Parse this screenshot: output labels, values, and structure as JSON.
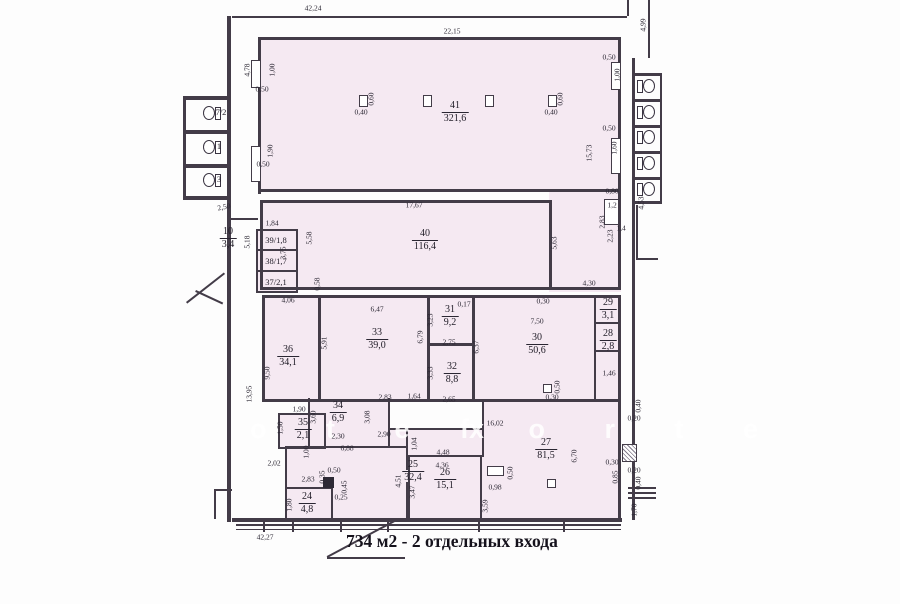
{
  "note": {
    "text": "734 м2 - 2 отдельных входа"
  },
  "plan": {
    "colors": {
      "fill": "#f5e9f2",
      "wall": "#433c48",
      "text": "#2a2632"
    },
    "watermark": [
      {
        "t": "o t e x",
        "x": 250,
        "y": 414
      },
      {
        "t": "f o r t e",
        "x": 460,
        "y": 414
      }
    ],
    "fills": [
      {
        "x": 258,
        "y": 37,
        "w": 363,
        "h": 155
      },
      {
        "x": 260,
        "y": 200,
        "w": 292,
        "h": 90
      },
      {
        "x": 549,
        "y": 190,
        "w": 72,
        "h": 102
      },
      {
        "x": 256,
        "y": 229,
        "w": 42,
        "h": 64
      },
      {
        "x": 262,
        "y": 295,
        "w": 359,
        "h": 107
      },
      {
        "x": 308,
        "y": 398,
        "w": 82,
        "h": 50
      },
      {
        "x": 278,
        "y": 413,
        "w": 48,
        "h": 36
      },
      {
        "x": 285,
        "y": 446,
        "w": 336,
        "h": 72
      },
      {
        "x": 482,
        "y": 402,
        "w": 139,
        "h": 116
      },
      {
        "x": 388,
        "y": 428,
        "w": 96,
        "h": 20
      }
    ],
    "walls": [
      {
        "x": 232,
        "y": 16,
        "w": 395,
        "h": 2
      },
      {
        "x": 227,
        "y": 16,
        "w": 4,
        "h": 506
      },
      {
        "x": 632,
        "y": 58,
        "w": 3,
        "h": 462
      },
      {
        "x": 627,
        "y": 0,
        "w": 2,
        "h": 16
      },
      {
        "x": 648,
        "y": 0,
        "w": 2,
        "h": 58
      },
      {
        "x": 232,
        "y": 518,
        "w": 390,
        "h": 4
      },
      {
        "x": 236,
        "y": 524,
        "w": 385,
        "h": 2
      },
      {
        "x": 236,
        "y": 529,
        "w": 385,
        "h": 1
      },
      {
        "x": 263,
        "y": 521,
        "w": 2,
        "h": 11
      },
      {
        "x": 292,
        "y": 521,
        "w": 2,
        "h": 11
      },
      {
        "x": 340,
        "y": 521,
        "w": 2,
        "h": 11
      },
      {
        "x": 387,
        "y": 521,
        "w": 2,
        "h": 11
      },
      {
        "x": 478,
        "y": 521,
        "w": 2,
        "h": 11
      },
      {
        "x": 563,
        "y": 521,
        "w": 2,
        "h": 11
      },
      {
        "x": 258,
        "y": 37,
        "w": 363,
        "h": 3
      },
      {
        "x": 258,
        "y": 37,
        "w": 3,
        "h": 157
      },
      {
        "x": 618,
        "y": 37,
        "w": 3,
        "h": 157
      },
      {
        "x": 258,
        "y": 189,
        "w": 363,
        "h": 3
      },
      {
        "x": 260,
        "y": 200,
        "w": 292,
        "h": 3
      },
      {
        "x": 260,
        "y": 200,
        "w": 3,
        "h": 90
      },
      {
        "x": 549,
        "y": 200,
        "w": 3,
        "h": 87
      },
      {
        "x": 260,
        "y": 287,
        "w": 361,
        "h": 3
      },
      {
        "x": 618,
        "y": 190,
        "w": 3,
        "h": 100
      },
      {
        "x": 256,
        "y": 229,
        "w": 42,
        "h": 2
      },
      {
        "x": 256,
        "y": 229,
        "w": 2,
        "h": 64
      },
      {
        "x": 296,
        "y": 229,
        "w": 2,
        "h": 64
      },
      {
        "x": 256,
        "y": 249,
        "w": 42,
        "h": 2
      },
      {
        "x": 256,
        "y": 270,
        "w": 42,
        "h": 2
      },
      {
        "x": 256,
        "y": 291,
        "w": 42,
        "h": 2
      },
      {
        "x": 230,
        "y": 218,
        "w": 28,
        "h": 2
      },
      {
        "x": 262,
        "y": 295,
        "w": 359,
        "h": 3
      },
      {
        "x": 262,
        "y": 295,
        "w": 3,
        "h": 107
      },
      {
        "x": 618,
        "y": 295,
        "w": 3,
        "h": 107
      },
      {
        "x": 262,
        "y": 399,
        "w": 359,
        "h": 3
      },
      {
        "x": 318,
        "y": 295,
        "w": 3,
        "h": 104
      },
      {
        "x": 427,
        "y": 295,
        "w": 3,
        "h": 104
      },
      {
        "x": 472,
        "y": 295,
        "w": 3,
        "h": 104
      },
      {
        "x": 427,
        "y": 343,
        "w": 45,
        "h": 3
      },
      {
        "x": 594,
        "y": 295,
        "w": 2,
        "h": 104
      },
      {
        "x": 594,
        "y": 322,
        "w": 26,
        "h": 2
      },
      {
        "x": 594,
        "y": 350,
        "w": 26,
        "h": 2
      },
      {
        "x": 308,
        "y": 398,
        "w": 2,
        "h": 50
      },
      {
        "x": 388,
        "y": 398,
        "w": 2,
        "h": 50
      },
      {
        "x": 308,
        "y": 446,
        "w": 82,
        "h": 2
      },
      {
        "x": 278,
        "y": 413,
        "w": 48,
        "h": 2
      },
      {
        "x": 278,
        "y": 413,
        "w": 2,
        "h": 36
      },
      {
        "x": 324,
        "y": 413,
        "w": 2,
        "h": 36
      },
      {
        "x": 278,
        "y": 447,
        "w": 48,
        "h": 2
      },
      {
        "x": 388,
        "y": 428,
        "w": 96,
        "h": 2
      },
      {
        "x": 285,
        "y": 446,
        "w": 2,
        "h": 72
      },
      {
        "x": 285,
        "y": 446,
        "w": 25,
        "h": 2
      },
      {
        "x": 406,
        "y": 428,
        "w": 2,
        "h": 42
      },
      {
        "x": 406,
        "y": 482,
        "w": 2,
        "h": 36
      },
      {
        "x": 390,
        "y": 446,
        "w": 18,
        "h": 2
      },
      {
        "x": 482,
        "y": 402,
        "w": 2,
        "h": 55
      },
      {
        "x": 408,
        "y": 455,
        "w": 74,
        "h": 2
      },
      {
        "x": 408,
        "y": 455,
        "w": 2,
        "h": 63
      },
      {
        "x": 480,
        "y": 455,
        "w": 2,
        "h": 63
      },
      {
        "x": 285,
        "y": 487,
        "w": 48,
        "h": 2
      },
      {
        "x": 331,
        "y": 487,
        "w": 2,
        "h": 31
      },
      {
        "x": 618,
        "y": 402,
        "w": 3,
        "h": 118
      },
      {
        "x": 634,
        "y": 73,
        "w": 28,
        "h": 3
      },
      {
        "x": 634,
        "y": 99,
        "w": 28,
        "h": 3
      },
      {
        "x": 634,
        "y": 125,
        "w": 28,
        "h": 3
      },
      {
        "x": 634,
        "y": 151,
        "w": 28,
        "h": 3
      },
      {
        "x": 634,
        "y": 177,
        "w": 28,
        "h": 3
      },
      {
        "x": 634,
        "y": 201,
        "w": 28,
        "h": 3
      },
      {
        "x": 660,
        "y": 73,
        "w": 2,
        "h": 131
      },
      {
        "x": 636,
        "y": 205,
        "w": 2,
        "h": 55
      },
      {
        "x": 636,
        "y": 258,
        "w": 22,
        "h": 2
      },
      {
        "x": 628,
        "y": 487,
        "w": 28,
        "h": 2
      },
      {
        "x": 628,
        "y": 492,
        "w": 28,
        "h": 2
      },
      {
        "x": 628,
        "y": 497,
        "w": 28,
        "h": 2
      },
      {
        "x": 183,
        "y": 96,
        "w": 47,
        "h": 4
      },
      {
        "x": 183,
        "y": 130,
        "w": 47,
        "h": 4
      },
      {
        "x": 183,
        "y": 164,
        "w": 47,
        "h": 4
      },
      {
        "x": 183,
        "y": 196,
        "w": 47,
        "h": 4
      },
      {
        "x": 183,
        "y": 96,
        "w": 3,
        "h": 104
      },
      {
        "x": 214,
        "y": 489,
        "w": 18,
        "h": 2
      },
      {
        "x": 214,
        "y": 489,
        "w": 2,
        "h": 30
      },
      {
        "x": 186,
        "y": 302,
        "w": 48,
        "h": 2,
        "r": -38
      },
      {
        "x": 196,
        "y": 290,
        "w": 30,
        "h": 2,
        "r": 25
      }
    ],
    "rooms": [
      {
        "n": "41",
        "a": "321,6",
        "x": 455,
        "y": 100
      },
      {
        "n": "40",
        "a": "116,4",
        "x": 425,
        "y": 228
      },
      {
        "n": "36",
        "a": "34,1",
        "x": 288,
        "y": 344
      },
      {
        "n": "33",
        "a": "39,0",
        "x": 377,
        "y": 327
      },
      {
        "n": "31",
        "a": "9,2",
        "x": 450,
        "y": 304
      },
      {
        "n": "32",
        "a": "8,8",
        "x": 452,
        "y": 361
      },
      {
        "n": "30",
        "a": "50,6",
        "x": 537,
        "y": 332
      },
      {
        "n": "29",
        "a": "3,1",
        "x": 608,
        "y": 297
      },
      {
        "n": "28",
        "a": "2,8",
        "x": 608,
        "y": 328
      },
      {
        "n": "34",
        "a": "6,9",
        "x": 338,
        "y": 400
      },
      {
        "n": "35",
        "a": "2,1",
        "x": 303,
        "y": 417
      },
      {
        "n": "25",
        "a": "32,4",
        "x": 413,
        "y": 459
      },
      {
        "n": "24",
        "a": "4,8",
        "x": 307,
        "y": 491
      },
      {
        "n": "26",
        "a": "15,1",
        "x": 445,
        "y": 467
      },
      {
        "n": "27",
        "a": "81,5",
        "x": 546,
        "y": 437
      },
      {
        "n": "10",
        "a": "3,4",
        "x": 228,
        "y": 226
      }
    ],
    "inline_labels": [
      {
        "t": "39/1,8",
        "x": 276,
        "y": 240
      },
      {
        "t": "38/1,7",
        "x": 276,
        "y": 261
      },
      {
        "t": "37/2,1",
        "x": 276,
        "y": 282
      },
      {
        "t": "7/2",
        "x": 221,
        "y": 112
      },
      {
        "t": "1",
        "x": 219,
        "y": 146
      },
      {
        "t": "3",
        "x": 219,
        "y": 179
      }
    ],
    "dims": [
      {
        "t": "42,24",
        "x": 313,
        "y": 8
      },
      {
        "t": "22,15",
        "x": 452,
        "y": 31
      },
      {
        "t": "4,99",
        "x": 643,
        "y": 25,
        "r": -90
      },
      {
        "t": "4,78",
        "x": 247,
        "y": 70,
        "r": -90
      },
      {
        "t": "1,00",
        "x": 272,
        "y": 70,
        "r": -90
      },
      {
        "t": "0,50",
        "x": 262,
        "y": 89
      },
      {
        "t": "0,60",
        "x": 371,
        "y": 99,
        "r": -90
      },
      {
        "t": "0,40",
        "x": 361,
        "y": 112
      },
      {
        "t": "0,60",
        "x": 560,
        "y": 99,
        "r": -90
      },
      {
        "t": "0,40",
        "x": 551,
        "y": 112
      },
      {
        "t": "0,50",
        "x": 609,
        "y": 57
      },
      {
        "t": "1,00",
        "x": 617,
        "y": 75,
        "r": -90
      },
      {
        "t": "0,50",
        "x": 609,
        "y": 128
      },
      {
        "t": "1,60",
        "x": 614,
        "y": 148,
        "r": -90
      },
      {
        "t": "15,73",
        "x": 589,
        "y": 153,
        "r": -90
      },
      {
        "t": "1,90",
        "x": 270,
        "y": 151,
        "r": -90
      },
      {
        "t": "0,50",
        "x": 263,
        "y": 164
      },
      {
        "t": "0,80",
        "x": 612,
        "y": 191
      },
      {
        "t": "2,83",
        "x": 602,
        "y": 222,
        "r": -90
      },
      {
        "t": "2,23",
        "x": 610,
        "y": 236,
        "r": -90
      },
      {
        "t": "1,2",
        "x": 612,
        "y": 205
      },
      {
        "t": "1,4",
        "x": 621,
        "y": 228
      },
      {
        "t": "4,53",
        "x": 641,
        "y": 203,
        "r": -90
      },
      {
        "t": "17,67",
        "x": 414,
        "y": 205
      },
      {
        "t": "1,84",
        "x": 272,
        "y": 223
      },
      {
        "t": "5,58",
        "x": 309,
        "y": 238,
        "r": -90
      },
      {
        "t": "3,75",
        "x": 283,
        "y": 253,
        "r": -90
      },
      {
        "t": "5,63",
        "x": 554,
        "y": 243,
        "r": -90
      },
      {
        "t": "4,30",
        "x": 589,
        "y": 283
      },
      {
        "t": "5,18",
        "x": 247,
        "y": 242,
        "r": -90
      },
      {
        "t": "2,50",
        "x": 224,
        "y": 207,
        "r": -12
      },
      {
        "t": "0,58",
        "x": 317,
        "y": 284,
        "r": -90
      },
      {
        "t": "4,06",
        "x": 288,
        "y": 300
      },
      {
        "t": "6,47",
        "x": 377,
        "y": 309
      },
      {
        "t": "0,17",
        "x": 464,
        "y": 304
      },
      {
        "t": "0,30",
        "x": 543,
        "y": 301
      },
      {
        "t": "7,50",
        "x": 537,
        "y": 321
      },
      {
        "t": "5,91",
        "x": 324,
        "y": 343,
        "r": -90
      },
      {
        "t": "9,50",
        "x": 267,
        "y": 373,
        "r": -90
      },
      {
        "t": "13,95",
        "x": 249,
        "y": 394,
        "r": -90
      },
      {
        "t": "3,23",
        "x": 430,
        "y": 320,
        "r": -90
      },
      {
        "t": "2,75",
        "x": 449,
        "y": 342
      },
      {
        "t": "6,79",
        "x": 420,
        "y": 337,
        "r": -90
      },
      {
        "t": "3,33",
        "x": 430,
        "y": 373,
        "r": -90
      },
      {
        "t": "2,65",
        "x": 449,
        "y": 399
      },
      {
        "t": "6,37",
        "x": 476,
        "y": 347,
        "r": -90
      },
      {
        "t": "2,83",
        "x": 385,
        "y": 397
      },
      {
        "t": "1,64",
        "x": 414,
        "y": 396
      },
      {
        "t": "0,30",
        "x": 552,
        "y": 397
      },
      {
        "t": "0,50",
        "x": 557,
        "y": 387,
        "r": -90
      },
      {
        "t": "1,46",
        "x": 609,
        "y": 373
      },
      {
        "t": "1,90",
        "x": 299,
        "y": 409
      },
      {
        "t": "1,50",
        "x": 280,
        "y": 428,
        "r": -90
      },
      {
        "t": "3,60",
        "x": 313,
        "y": 417,
        "r": -90
      },
      {
        "t": "3,08",
        "x": 367,
        "y": 417,
        "r": -90
      },
      {
        "t": "2,30",
        "x": 338,
        "y": 436
      },
      {
        "t": "2,90",
        "x": 384,
        "y": 434
      },
      {
        "t": "6,88",
        "x": 347,
        "y": 448
      },
      {
        "t": "1,04",
        "x": 414,
        "y": 444,
        "r": -90
      },
      {
        "t": "1,00",
        "x": 306,
        "y": 452,
        "r": -90
      },
      {
        "t": "2,02",
        "x": 274,
        "y": 463
      },
      {
        "t": "16,02",
        "x": 495,
        "y": 423
      },
      {
        "t": "4,48",
        "x": 443,
        "y": 452
      },
      {
        "t": "4,36",
        "x": 442,
        "y": 465
      },
      {
        "t": "2,83",
        "x": 308,
        "y": 479
      },
      {
        "t": "0,35",
        "x": 322,
        "y": 477,
        "r": -90
      },
      {
        "t": "0,50",
        "x": 334,
        "y": 470
      },
      {
        "t": "0,45",
        "x": 344,
        "y": 487,
        "r": -90
      },
      {
        "t": "0,25",
        "x": 341,
        "y": 497
      },
      {
        "t": "1,80",
        "x": 289,
        "y": 505,
        "r": -90
      },
      {
        "t": "4,51",
        "x": 398,
        "y": 481,
        "r": -90
      },
      {
        "t": "3,47",
        "x": 412,
        "y": 492,
        "r": -90
      },
      {
        "t": "3,59",
        "x": 485,
        "y": 506,
        "r": -90
      },
      {
        "t": "6,70",
        "x": 574,
        "y": 456,
        "r": -90
      },
      {
        "t": "0,98",
        "x": 495,
        "y": 487
      },
      {
        "t": "0,50",
        "x": 510,
        "y": 473,
        "r": -90
      },
      {
        "t": "0,30",
        "x": 612,
        "y": 462
      },
      {
        "t": "0,85",
        "x": 615,
        "y": 477,
        "r": -90
      },
      {
        "t": "0,20",
        "x": 634,
        "y": 470
      },
      {
        "t": "0,40",
        "x": 638,
        "y": 483,
        "r": -90
      },
      {
        "t": "0,20",
        "x": 634,
        "y": 418
      },
      {
        "t": "0,40",
        "x": 638,
        "y": 406,
        "r": -90
      },
      {
        "t": "1,70",
        "x": 634,
        "y": 510,
        "r": -90
      },
      {
        "t": "42,27",
        "x": 265,
        "y": 537
      }
    ],
    "boxes": [
      {
        "x": 359,
        "y": 95,
        "w": 9,
        "h": 12
      },
      {
        "x": 423,
        "y": 95,
        "w": 9,
        "h": 12
      },
      {
        "x": 485,
        "y": 95,
        "w": 9,
        "h": 12
      },
      {
        "x": 548,
        "y": 95,
        "w": 9,
        "h": 12
      },
      {
        "x": 251,
        "y": 60,
        "w": 10,
        "h": 28
      },
      {
        "x": 251,
        "y": 146,
        "w": 10,
        "h": 36
      },
      {
        "x": 611,
        "y": 62,
        "w": 10,
        "h": 28
      },
      {
        "x": 611,
        "y": 138,
        "w": 10,
        "h": 36
      },
      {
        "x": 604,
        "y": 199,
        "w": 15,
        "h": 26
      },
      {
        "x": 543,
        "y": 384,
        "w": 9,
        "h": 9
      },
      {
        "x": 487,
        "y": 466,
        "w": 17,
        "h": 10
      },
      {
        "x": 547,
        "y": 479,
        "w": 9,
        "h": 9
      },
      {
        "x": 323,
        "y": 477,
        "w": 11,
        "h": 11,
        "v": "filled"
      },
      {
        "x": 622,
        "y": 444,
        "w": 15,
        "h": 18,
        "v": "hatch"
      }
    ],
    "toilets": [
      {
        "x": 201,
        "y": 105,
        "f": 1
      },
      {
        "x": 201,
        "y": 139,
        "f": 1
      },
      {
        "x": 201,
        "y": 172,
        "f": 1
      },
      {
        "x": 637,
        "y": 78,
        "f": 0
      },
      {
        "x": 637,
        "y": 104,
        "f": 0
      },
      {
        "x": 637,
        "y": 129,
        "f": 0
      },
      {
        "x": 637,
        "y": 155,
        "f": 0
      },
      {
        "x": 637,
        "y": 181,
        "f": 0
      }
    ]
  }
}
